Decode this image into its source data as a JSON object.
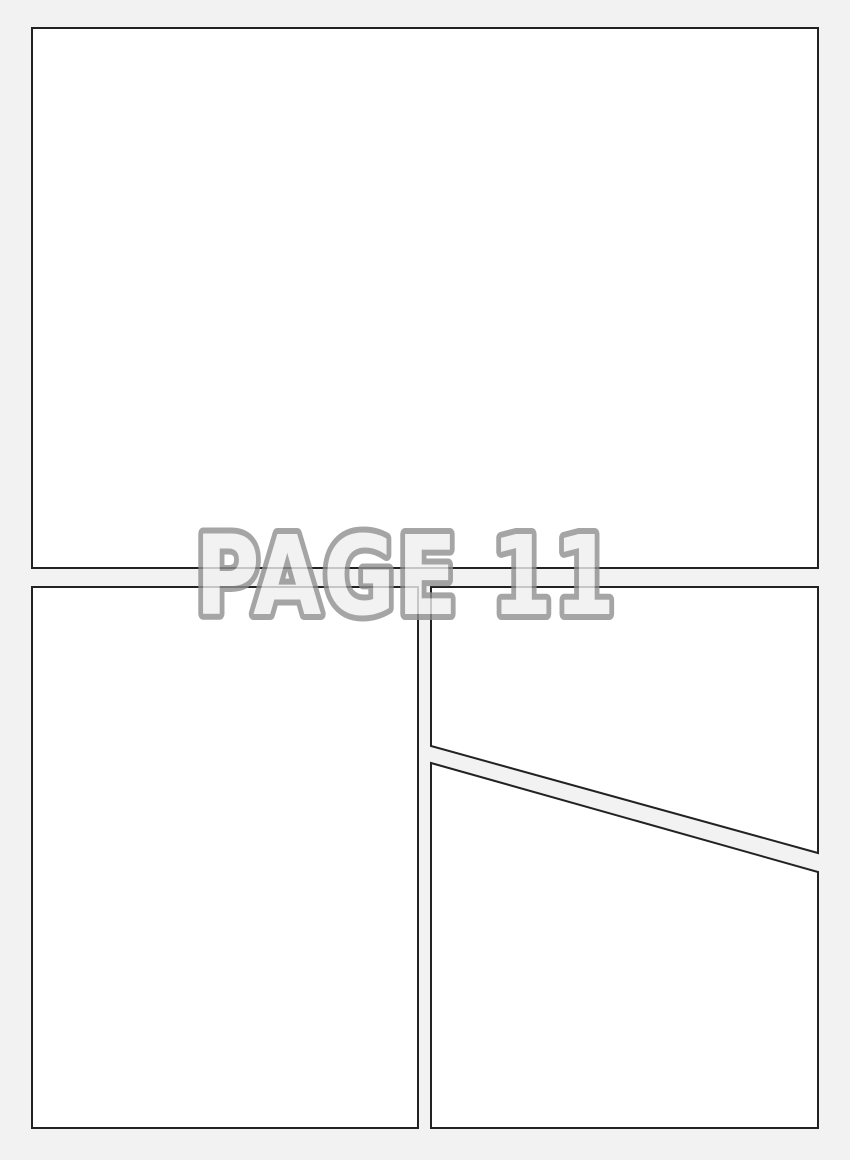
{
  "watermark": {
    "text": "PAGE 11"
  },
  "colors": {
    "page_background": "#f2f2f2",
    "panel_fill": "#ffffff",
    "panel_border": "#222222",
    "watermark_fill": "#f0f0f0",
    "watermark_outline": "#8f8f8f"
  },
  "panels": [
    {
      "name": "top full-width panel"
    },
    {
      "name": "bottom-left tall panel"
    },
    {
      "name": "right upper panel with diagonal bottom edge"
    },
    {
      "name": "right lower panel with diagonal top edge"
    }
  ]
}
